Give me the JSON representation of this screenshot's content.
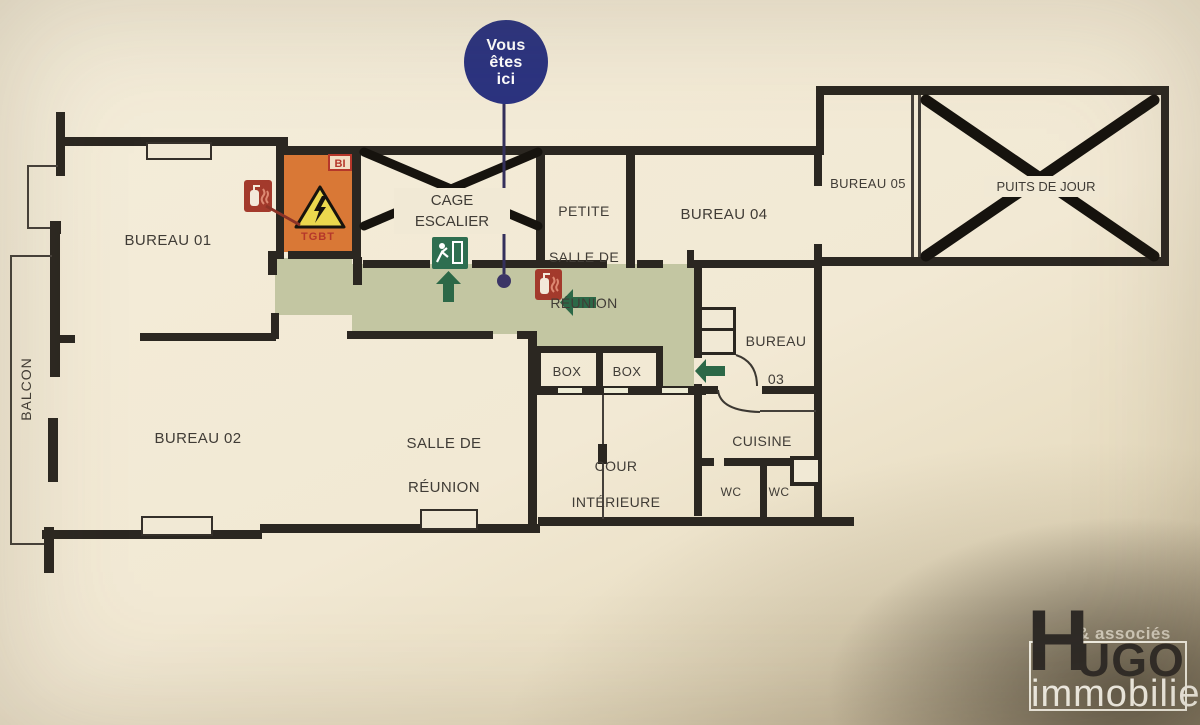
{
  "badge": {
    "line1": "Vous",
    "line2": "êtes",
    "line3": "ici"
  },
  "rooms": {
    "balcon": {
      "label": "BALCON"
    },
    "bureau01": {
      "label": "BUREAU 01"
    },
    "bureau02": {
      "label": "BUREAU 02"
    },
    "bureau03": {
      "line1": "BUREAU",
      "line2": "03"
    },
    "bureau04": {
      "label": "BUREAU 04"
    },
    "bureau05": {
      "label": "BUREAU 05"
    },
    "cage_escalier": {
      "line1": "CAGE",
      "line2": "ESCALIER"
    },
    "petite_salle_de_reunion": {
      "line1": "PETITE",
      "line2": "SALLE DE",
      "line3": "RÉUNION"
    },
    "salle_de_reunion": {
      "line1": "SALLE DE",
      "line2": "RÉUNION"
    },
    "cour_interieure": {
      "line1": "COUR",
      "line2": "INTÉRIEURE"
    },
    "cuisine": {
      "label": "CUISINE"
    },
    "wc_left": {
      "label": "WC"
    },
    "wc_right": {
      "label": "WC"
    },
    "box_left": {
      "label": "BOX"
    },
    "box_right": {
      "label": "BOX"
    },
    "puits_de_jour": {
      "label": "PUITS DE JOUR"
    }
  },
  "safety": {
    "tgbt_label": "TGBT",
    "bi_label": "BI",
    "icon_names": [
      "fire-extinguisher-icon",
      "electrical-hazard-icon",
      "emergency-exit-icon",
      "evacuation-arrow-up-icon",
      "evacuation-arrow-left-icon",
      "you-are-here-dot"
    ]
  },
  "logo": {
    "associes": "& associés",
    "h": "H",
    "ugo": "UGO",
    "immobilier": "immobilier"
  },
  "colors": {
    "corridor_green": "#c3c6a2",
    "evacuation_green": "#2c6847",
    "tgbt_orange": "#d97836",
    "hazard_yellow": "#ecd84e",
    "extinguisher_red": "#a33a2c",
    "badge_navy": "#2b3380",
    "wall_dark": "#2b2721",
    "paper": "#f1e9d5"
  }
}
